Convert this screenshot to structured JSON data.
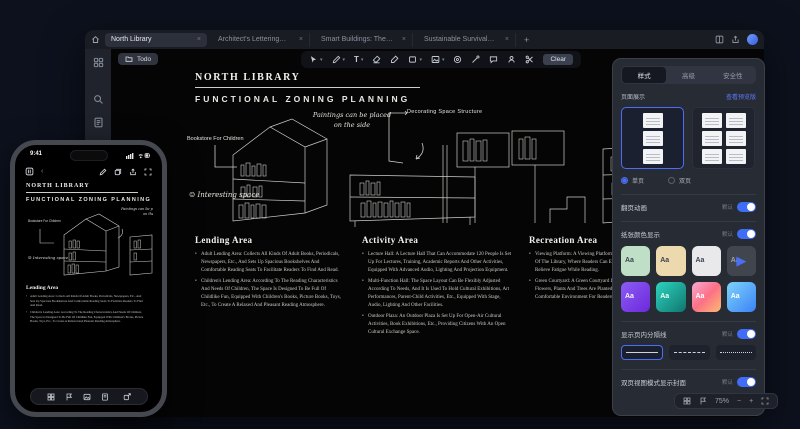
{
  "window": {
    "tabs": [
      {
        "label": "North Library",
        "close": "×"
      },
      {
        "label": "Architect's Lettering…",
        "close": "×"
      },
      {
        "label": "Smart Buildings: The…",
        "close": "×"
      },
      {
        "label": "Sustainable Survival…",
        "close": "×"
      }
    ],
    "new_tab_label": "+",
    "todo_label": "Todo",
    "clear_label": "Clear",
    "text_tool_label": "T",
    "zoom_percent": "75%"
  },
  "doc": {
    "title": "NORTH LIBRARY",
    "subtitle": "FUNCTIONAL ZONING PLANNING",
    "annotations": {
      "paintings": "Paintings can be placed on the side",
      "decorating": "Decorating Space Structure",
      "bookstore": "Bookstore For Children",
      "interesting": "Interesting space",
      "smiley": "☺"
    },
    "sections": [
      {
        "heading": "Lending Area",
        "bullets": [
          "Adult Lending Area: Collects All Kinds Of Adult Books, Periodicals, Newspapers, Etc., And Sets Up Spacious Bookshelves And Comfortable Reading Seats To Facilitate Readers To Find And Read.",
          "Children's Lending Area: According To The Reading Characteristics And Needs Of Children, The Space Is Designed To Be Full Of Childlike Fun, Equipped With Children's Books, Picture Books, Toys, Etc., To Create A Relaxed And Pleasant Reading Atmosphere."
        ]
      },
      {
        "heading": "Activity Area",
        "bullets": [
          "Lecture Hall: A Lecture Hall That Can Accommodate 120 People Is Set Up For Lectures, Training, Academic Reports And Other Activities, Equipped With Advanced Audio, Lighting And Projection Equipment.",
          "Multi-Function Hall: The Space Layout Can Be Flexibly Adjusted According To Needs, And It Is Used To Hold Cultural Exhibitions, Art Performances, Parent-Child Activities, Etc., Equipped With Stage, Audio, Lighting And Other Facilities.",
          "Outdoor Plaza: An Outdoor Plaza Is Set Up For Open-Air Cultural Activities, Book Exhibitions, Etc., Providing Citizens With An Open Cultural Exchange Space."
        ]
      },
      {
        "heading": "Recreation Area",
        "bullets": [
          "Viewing Platform: A Viewing Platform Is Set Up On The Upper Floors Of The Library, Where Readers Can Enjoy The Beautiful Scenery And Relieve Fatigue While Reading.",
          "Green Courtyard: A Green Courtyard Is Set Up In The Library, Where Flowers, Plants And Trees Are Planted To Create A Quiet And Comfortable Environment For Readers To Rest."
        ]
      }
    ]
  },
  "panel": {
    "tabs": [
      "样式",
      "高级",
      "安全性"
    ],
    "preview": {
      "label": "页面展示",
      "link": "查看预览版",
      "options": [
        "单页",
        "双页"
      ]
    },
    "toggles": [
      {
        "label": "翻页动画",
        "hint": "默认"
      },
      {
        "label": "纸张颜色显示",
        "hint": "默认"
      },
      {
        "label": "显示页内分隔线",
        "hint": "默认"
      },
      {
        "label": "双页视图模式显示封面",
        "hint": "默认"
      }
    ],
    "tile_label": "Aa",
    "play_glyph": "▶",
    "tile_colors": [
      "#bfe0c6",
      "#ecd9ae",
      "#e9e9ec",
      "#41464e",
      "linear-gradient(135deg,#8b5cf6,#6d28d9)",
      "linear-gradient(135deg,#2dd4bf,#0f766e)",
      "linear-gradient(135deg,#f9a8d4,#fb7185,#fdba74)",
      "linear-gradient(135deg,#7dd3fc,#3b82f6)"
    ],
    "tile_text_colors": [
      "#3d4450",
      "#3d4450",
      "#3d4450",
      "#9aa0aa",
      "#f4f6f9",
      "#eafffb",
      "#ffffff",
      "#ffffff"
    ],
    "accent": "#4c6ef5"
  },
  "phone": {
    "time": "9:41"
  }
}
